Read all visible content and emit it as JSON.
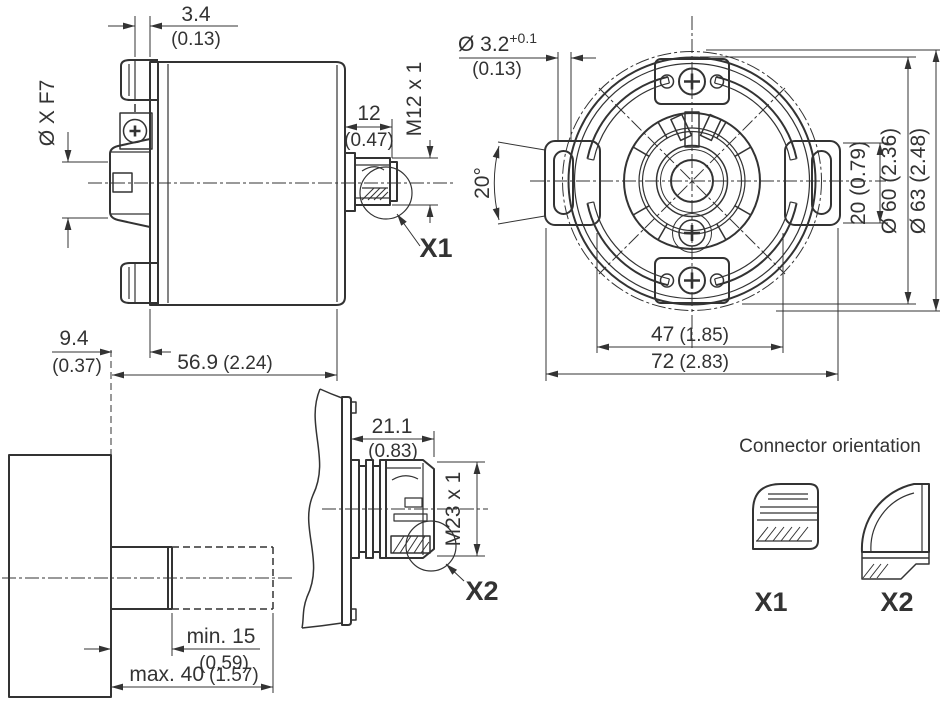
{
  "colors": {
    "line": "#333333",
    "background": "#ffffff"
  },
  "side_view": {
    "gap": {
      "mm": "3.4",
      "in": "(0.13)"
    },
    "bore": "Ø X F7",
    "conn_len": {
      "mm": "12",
      "in": "(0.47)"
    },
    "conn_thread": "M12 x 1",
    "conn_label": "X1",
    "depth": {
      "mm": "9.4",
      "in": "(0.37)"
    },
    "length": {
      "mm": "56.9",
      "in": "(2.24)"
    }
  },
  "front_view": {
    "slot_width": {
      "mm": "Ø 3.2",
      "tol": "+0.1",
      "in": "(0.13)"
    },
    "slot_angle": "20°",
    "slot_length": "20 (0.79)",
    "dia_body": "Ø 60 (2.36)",
    "dia_overall": "Ø 63 (2.48)",
    "span_inner": {
      "mm": "47",
      "in": "(1.85)"
    },
    "span_overall": {
      "mm": "72",
      "in": "(2.83)"
    }
  },
  "shaft_view": {
    "insert_min": {
      "mm": "min. 15",
      "in": "(0.59)"
    },
    "insert_max": {
      "mm": "max. 40",
      "in": "(1.57)"
    }
  },
  "x2_view": {
    "conn_len": {
      "mm": "21.1",
      "in": "(0.83)"
    },
    "conn_thread": "M23 x 1",
    "conn_label": "X2"
  },
  "orientation": {
    "title": "Connector orientation",
    "x1_label": "X1",
    "x2_label": "X2"
  }
}
